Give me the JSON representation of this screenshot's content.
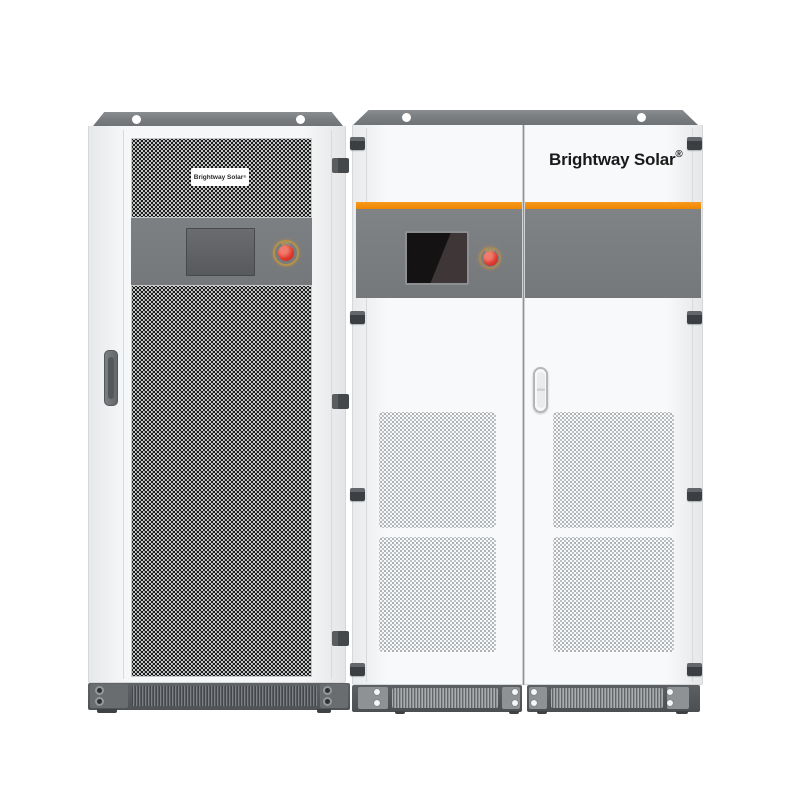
{
  "product": {
    "left_cabinet": {
      "label_text": "Brightway Solar",
      "label_registered": "®",
      "epo_label": "EPO"
    },
    "right_cabinet": {
      "brand_text": "Brightway Solar",
      "brand_registered": "®",
      "epo_label": "EPO"
    },
    "colors": {
      "background": "#ffffff",
      "cabinet_body": "#f6f7f8",
      "top_cap_gray": "#7b7e81",
      "control_band_gray": "#77797c",
      "accent_stripe_orange": "#f08a00",
      "emergency_button_red": "#df382d",
      "button_ring_gold": "#b3924a",
      "base_gray": "#54575a",
      "display_screen_black": "#151213",
      "mesh_dot_dark": "#1c1c1c"
    }
  }
}
